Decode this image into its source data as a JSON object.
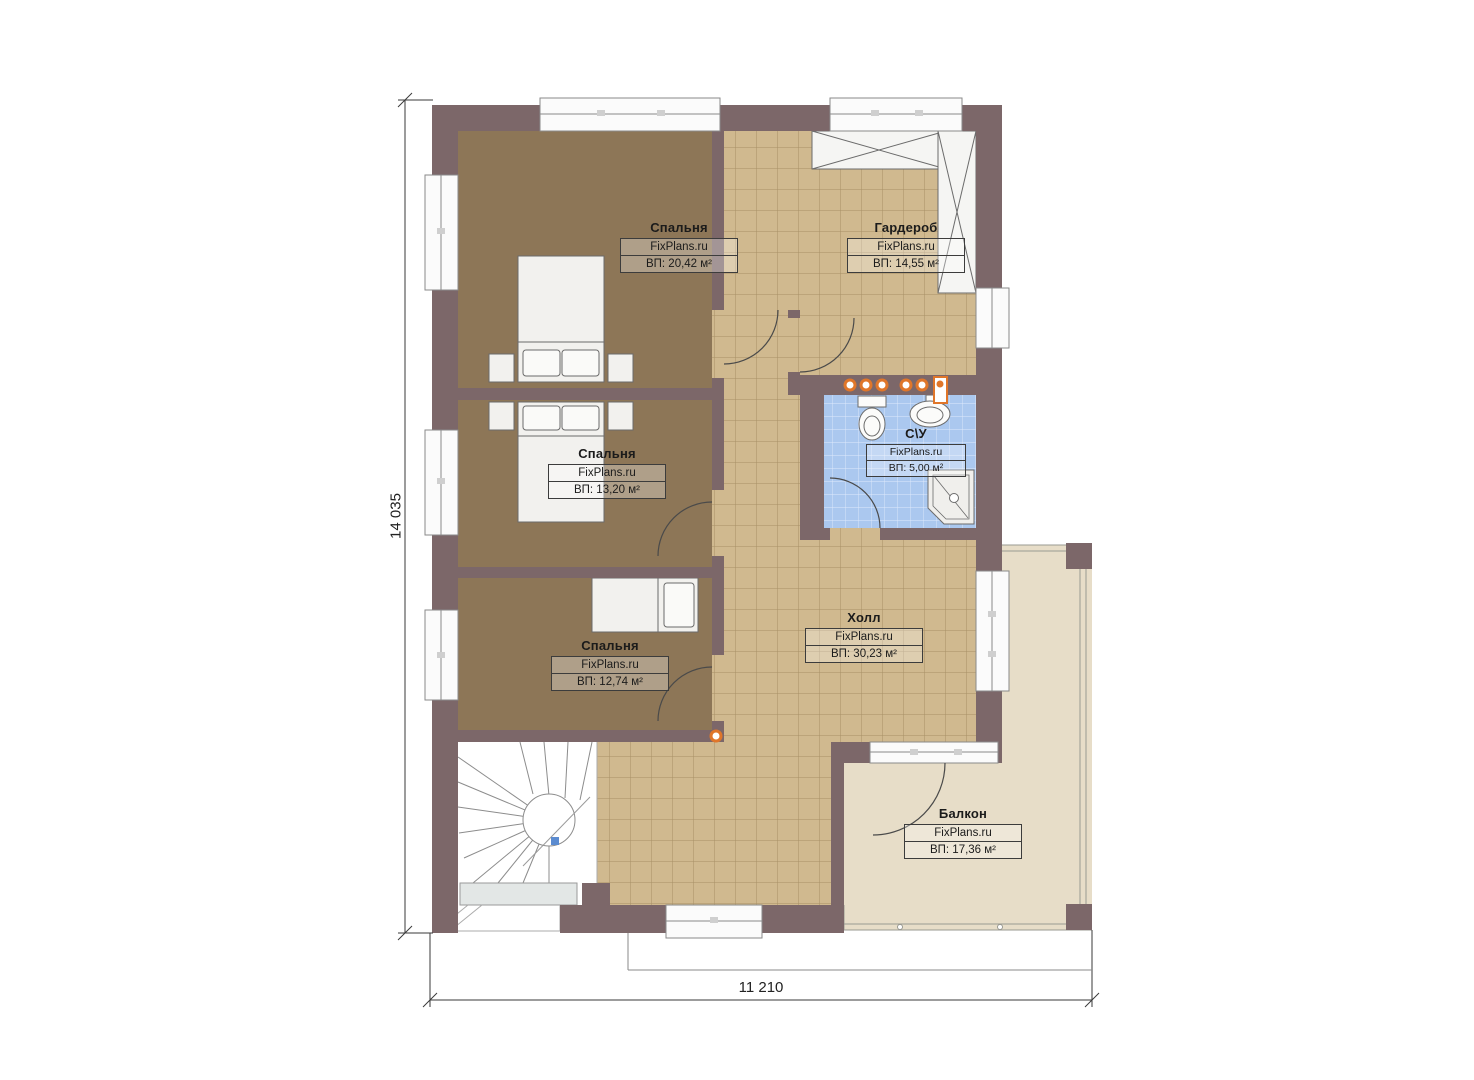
{
  "plan": {
    "brand": "FixPlans.ru",
    "rooms": [
      {
        "id": "bedroom-1",
        "name": "Спальня",
        "area_label": "ВП: 20,42 м²"
      },
      {
        "id": "wardrobe",
        "name": "Гардероб",
        "area_label": "ВП: 14,55 м²"
      },
      {
        "id": "bedroom-2",
        "name": "Спальня",
        "area_label": "ВП: 13,20 м²"
      },
      {
        "id": "bathroom",
        "name": "С\\У",
        "area_label": "ВП: 5,00 м²"
      },
      {
        "id": "bedroom-3",
        "name": "Спальня",
        "area_label": "ВП: 12,74 м²"
      },
      {
        "id": "hall",
        "name": "Холл",
        "area_label": "ВП: 30,23 м²"
      },
      {
        "id": "balcony",
        "name": "Балкон",
        "area_label": "ВП: 17,36 м²"
      }
    ],
    "dimensions": {
      "height_label": "14 035",
      "width_label": "11 210"
    },
    "colors": {
      "wall": "#7c6769",
      "bedroom_carpet": "#8d7657",
      "floor_tile": "#d0b98f",
      "tile_grid": "#a78f66",
      "bathroom_tile": "#abc8ef",
      "balcony_floor": "#e7ddc8",
      "plumbing_accent": "#e0762a",
      "stair_marker_blue": "#5b8bd0"
    }
  }
}
